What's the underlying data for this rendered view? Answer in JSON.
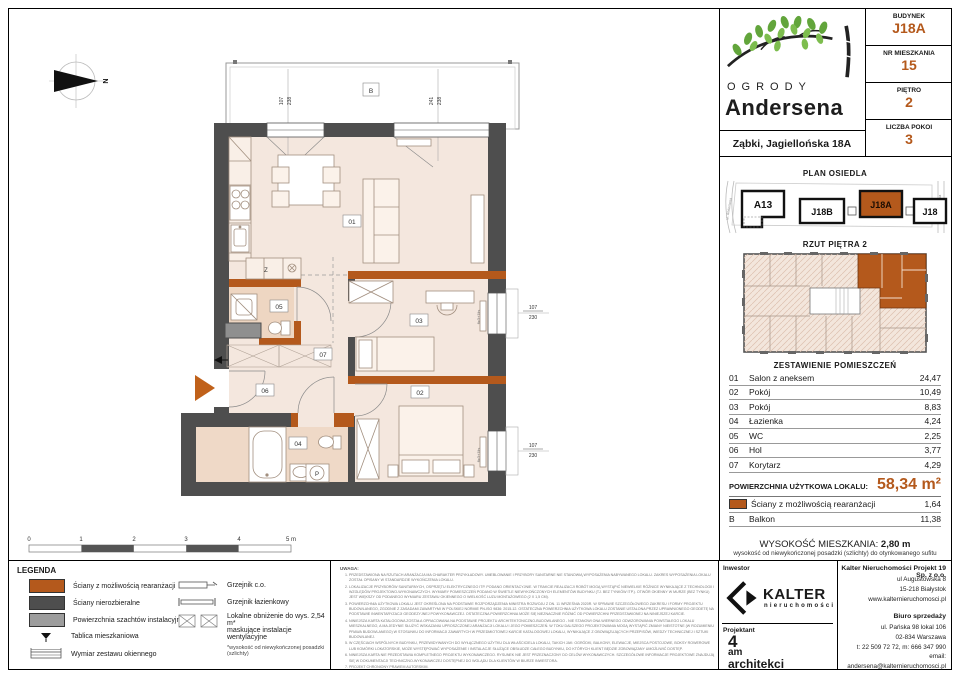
{
  "colors": {
    "accent": "#b4591c",
    "wall_dark": "#4e4e4e",
    "wall_orange": "#b4591c",
    "shaft_gray": "#8f8f8f",
    "room_fill": "#f4e7de"
  },
  "header": {
    "brand_top": "OGRODY",
    "brand_name": "Andersena",
    "address": "Ząbki, Jagiellońska 18A",
    "fields": [
      {
        "label": "BUDYNEK",
        "value": "J18A"
      },
      {
        "label": "NR MIESZKANIA",
        "value": "15"
      },
      {
        "label": "PIĘTRO",
        "value": "2"
      },
      {
        "label": "LICZBA POKOI",
        "value": "3"
      }
    ]
  },
  "site_plan": {
    "title": "PLAN OSIEDLA",
    "street_left": "ul. Andersena",
    "street_right": "ul. Jagiellońska",
    "buildings": {
      "a13": "A13",
      "j18b": "J18B",
      "j18a": "J18A",
      "j18": "J18"
    }
  },
  "floor_overview": {
    "title": "RZUT PIĘTRA 2"
  },
  "rooms_table": {
    "title": "ZESTAWIENIE POMIESZCZEŃ",
    "rows": [
      {
        "no": "01",
        "name": "Salon z aneksem",
        "area": "24,47"
      },
      {
        "no": "02",
        "name": "Pokój",
        "area": "10,49"
      },
      {
        "no": "03",
        "name": "Pokój",
        "area": "8,83"
      },
      {
        "no": "04",
        "name": "Łazienka",
        "area": "4,24"
      },
      {
        "no": "05",
        "name": "WC",
        "area": "2,25"
      },
      {
        "no": "06",
        "name": "Hol",
        "area": "3,77"
      },
      {
        "no": "07",
        "name": "Korytarz",
        "area": "4,29"
      }
    ],
    "total_label": "POWIERZCHNIA UŻYTKOWA LOKALU:",
    "total_value": "58,34 m²",
    "wall_row": {
      "name": "Ściany z możliwością rearanżacji",
      "area": "1,64"
    },
    "balcony_row": {
      "no": "B",
      "name": "Balkon",
      "area": "11,38"
    }
  },
  "height_info": {
    "label": "WYSOKOŚĆ MIESZKANIA:",
    "value": "2,80 m",
    "sub": "wysokość od niewykończonej posadzki (szlichty) do otynkowanego sufitu"
  },
  "footer": {
    "investor_label": "Inwestor",
    "kalter_name": "KALTER",
    "kalter_sub": "nieruchomości",
    "designer_label": "Projektant",
    "am_1": "4",
    "am_2": "am",
    "am_3": "architekci",
    "company_name": "Kalter Nieruchomości Projekt 19 Sp. z o.o.",
    "company_lines": [
      "ul Augustowska 8",
      "15-218 Białystok",
      "www.kalternieruchomosci.pl"
    ],
    "sales_title": "Biuro sprzedaży",
    "sales_lines": [
      "ul. Pańska 98 lokal 106",
      "02-834 Warszawa",
      "t: 22 509 72 72, m: 666 347 990",
      "email: andersena@kalternieruchomosci.pl"
    ]
  },
  "legend": {
    "title": "LEGENDA",
    "col1": [
      "Ściany z możliwością rearanżacji",
      "Ściany nierozbieralne",
      "Powierzchnia szachtów instalacyjnych",
      "Tablica mieszkaniowa",
      "Wymiar zestawu okiennego"
    ],
    "col2": [
      "Grzejnik c.o.",
      "Grzejnik łazienkowy",
      "Lokalne obniżenie do wys. 2,54 m*",
      "maskujące instalacje wentylacyjne",
      "*wysokość od niewykończonej posadzki (szlichty)"
    ]
  },
  "scalebar": {
    "t0": "0",
    "t1": "1",
    "t2": "2",
    "t3": "3",
    "t4": "4",
    "t5": "5 m"
  },
  "notes": {
    "title": "UWAGA:",
    "items": [
      "PRZEDSTAWIONA NA RZUTACH ARANŻACJA MA CHARAKTER PRZYKŁADOWY. UMEBLOWANIE I PRZYBORY SANITARNE NIE STANOWIĄ WYPOSAŻENIA NABYWANEGO LOKALU. ZAKRES WYPOSAŻENIA LOKALU ZOSTAŁ OPISANY W STANDARDZIE WYKOŃCZENIA LOKALU.",
      "LOKALIZACJE PRZYBORÓW SANITARNYCH, OSPRZĘTU ELEKTRYCZNEGO ITP. PODANO ORIENTACYJNIE. W TRAKCIE REALIZACJI ROBÓT MOGĄ WYSTĄPIĆ NIEWIELKIE RÓŻNICE WYNIKAJĄCE Z TECHNOLOGII I WZGLĘDÓW PROJEKTOWO-WYKONAWCZYCH. WYMIARY POMIESZCZEŃ PODANO W ŚWIETLE NIEWYKOŃCZONYCH ELEMENTÓW BUDYNKU (TJ. BEZ TYNKÓW ITP.). OTWÓR OKIENNY W MURZE (BEZ TYNKU) JEST WIĘKSZY OD PODANEGO WYMIARU ZESTAWU OKIENNEGO O WIELKOŚĆ LUZU MONTAŻOWEGO (2 X 1,5 CM).",
      "POWIERZCHNIA UŻYTKOWA LOKALU JEST OKREŚLONA NA PODSTAWIE ROZPORZĄDZENIA MINISTRA ROZWOJU Z DN. 11 WRZEŚNIA 2020R. W SPRAWIE SZCZEGÓŁOWEGO ZAKRESU I FORMY PROJEKTU BUDOWLANEGO, ZGODNIE Z ZASADAMI ZAWARTYMI W POLSKIEJ NORMIE PN-ISO 9836: 2015-12. OSTATECZNA POWIERZCHNIA UŻYTKOWA LOKALU ZOSTANIE USTALONA PRZEZ UPRAWNIONEGO GEODETĘ NA PODSTAWIE INWENTARYZACJI GEODEZYJNEJ POWYKONAWCZEJ. OSTATECZNA POWIERZCHNIA MOŻE SIĘ NIEZNACZNIE RÓŻNIĆ OD POWIERZCHNI PRZEDSTAWIONEJ NA NINIEJSZEJ KARCIE.",
      "NINIEJSZA KARTA KATALOGOWA ZOSTAŁA OPRACOWANA NA PODSTAWIE PROJEKTU ARCHITEKTONICZNO-BUDOWLANEGO - NIE STANOWI ONA WIERNEGO ODWZOROWANIA POWSTAŁEGO LOKALU MIESZKALNEGO, A MA JEDYNIE SŁUŻYĆ WSKAZANIU UPROSZCZONEJ ARANŻACJI LOKALU I JEGO POMIESZCZEŃ. W TOKU DALSZEGO PROJEKTOWANIA MOGĄ WYSTĄPIĆ ZMIANY NIEISTOTNE (W ROZUMIENIU PRAWA BUDOWLANEGO) W STOSUNKU DO INFORMACJI ZAWARTYCH W PRZEDMIOTOWEJ KARCIE KATALOGOWEJ LOKALU, WYNIKAJĄCE Z OBOWIĄZUJĄCYCH PRZEPISÓW, WIEDZY TECHNICZNEJ I SZTUKI BUDOWLANEJ.",
      "W CZĘŚCIACH WSPÓLNYCH BUDYNKU, PRZEWIDYWANYCH DO WYŁĄCZNEGO UŻYTKU DLA WŁAŚCICIELA LOKALU, TAKICH JAK: OGRÓDKI, BALKONY, ELEWACJE, MIEJSCA POSTOJOWE, BOKSY ROWEROWE LUB KOMÓRKI LOKATORSKIE, MOŻE WYSTĘPOWAĆ WYPOSAŻENIE I INSTALACJE SŁUŻĄCE OBSŁUDZE CAŁEGO BUDYNKU, DO KTÓRYCH KLIENT BĘDZIE ZOBOWIĄZANY UMOŻLIWIĆ DOSTĘP.",
      "NINIEJSZA KARTA NIE PRZEDSTAWIA KOMPLETNEGO PROJEKTU WYKONAWCZEGO. RYSUNEK NIE JEST PRZEZNACZONY DO CELÓW WYKONAWCZYCH. SZCZEGÓŁOWE INFORMACJE PROJEKTOWE ZNAJDUJĄ SIĘ W DOKUMENTACJI TECHNICZNO-WYKONAWCZEJ DOSTĘPNEJ DO WGLĄDU DLA KLIENTÓW W BIURZE INWESTORA.",
      "PROJEKT CHRONIONY PRAWEM AUTORSKIM."
    ]
  },
  "plan": {
    "north": "N",
    "balcony": "B",
    "labels": {
      "r01": "01",
      "r02": "02",
      "r03": "03",
      "r04": "04",
      "r05": "05",
      "r06": "06",
      "r07": "07"
    },
    "texts": {
      "z": "Z",
      "p": "P",
      "window_spec": "fix3+1lis"
    },
    "dims": {
      "w1": "107",
      "h1": "238",
      "w2": "241",
      "h2": "238",
      "w3": "107",
      "h3": "230",
      "w4": "107",
      "h4": "230"
    }
  }
}
